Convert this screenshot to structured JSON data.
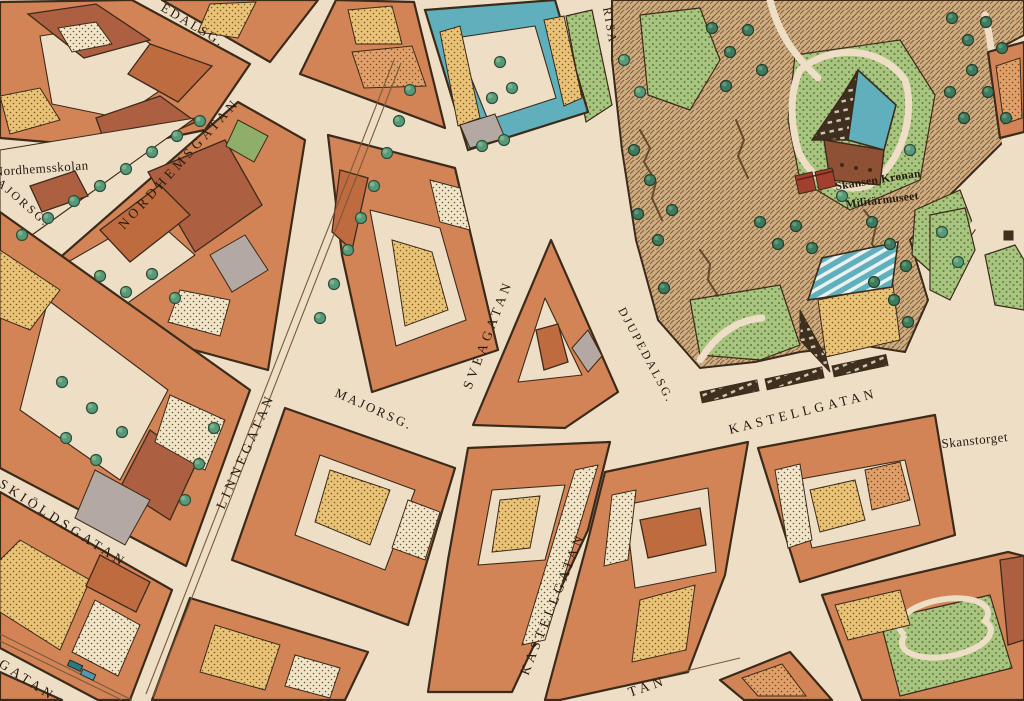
{
  "map": {
    "kind": "isometric-city-map"
  },
  "palette": {
    "paper": "#eedec6",
    "roofOrange": "#d28457",
    "roofDeep": "#bf6b40",
    "redBrown": "#ad5f41",
    "outline": "#3c2a1a",
    "teal": "#5fb0bc",
    "grayRoof": "#b3a9a2",
    "ink": "#241a0e",
    "treeMid": "#57997b",
    "treeDark": "#3f7a5e",
    "grass": "#a9c47e",
    "rock": "#cdad82"
  },
  "labels": {
    "edalsg": {
      "text": "EDALSG."
    },
    "nordhemsgatan": {
      "text": "NORDHEMSGATAN"
    },
    "nordhemsskolan": {
      "text": "Nordhemsskolan"
    },
    "majorsg_w": {
      "text": "AJORSG."
    },
    "risasg": {
      "text": "RISA"
    },
    "sveagatan": {
      "text": "SVEAGATAN"
    },
    "majorsg": {
      "text": "MAJORSG."
    },
    "linnegatan": {
      "text": "LINNEGATAN"
    },
    "djupedalsg": {
      "text": "DJUPEDALSG."
    },
    "kastellgatan_e": {
      "text": "KASTELLGATAN"
    },
    "kastellgatan_s": {
      "text": "KASTELLGATAN"
    },
    "skanstorget": {
      "text": "Skanstorget"
    },
    "skioldsgatan": {
      "text": "SKIÖLDSGATAN"
    },
    "gatan_sw": {
      "text": "GATAN"
    },
    "gatan_s": {
      "text": "TAN"
    },
    "skansen_kronan": {
      "text": "Skansen Kronan"
    },
    "militarmuseet": {
      "text": "Militärmuseet"
    }
  }
}
